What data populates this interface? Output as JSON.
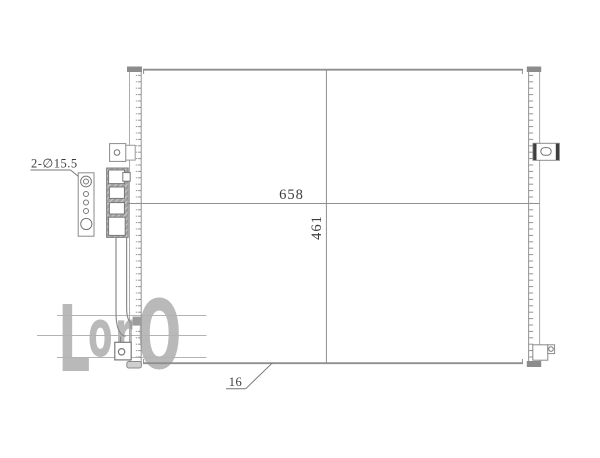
{
  "labels": {
    "width": "658",
    "height": "461",
    "bottom_leader": "16",
    "mounting_holes": "2-∅15.5"
  },
  "watermark": {
    "l1": "L",
    "l2": "o",
    "l3": "r",
    "l4": "O"
  },
  "colors": {
    "line_gray": "#8f8f8f",
    "fill_dark_cap": "#8c8c8c",
    "hatch_gray": "#a2a2a2",
    "watermark_gray": "#b9b9b9",
    "text_dark": "#3d3d3d",
    "background": "#ffffff"
  }
}
